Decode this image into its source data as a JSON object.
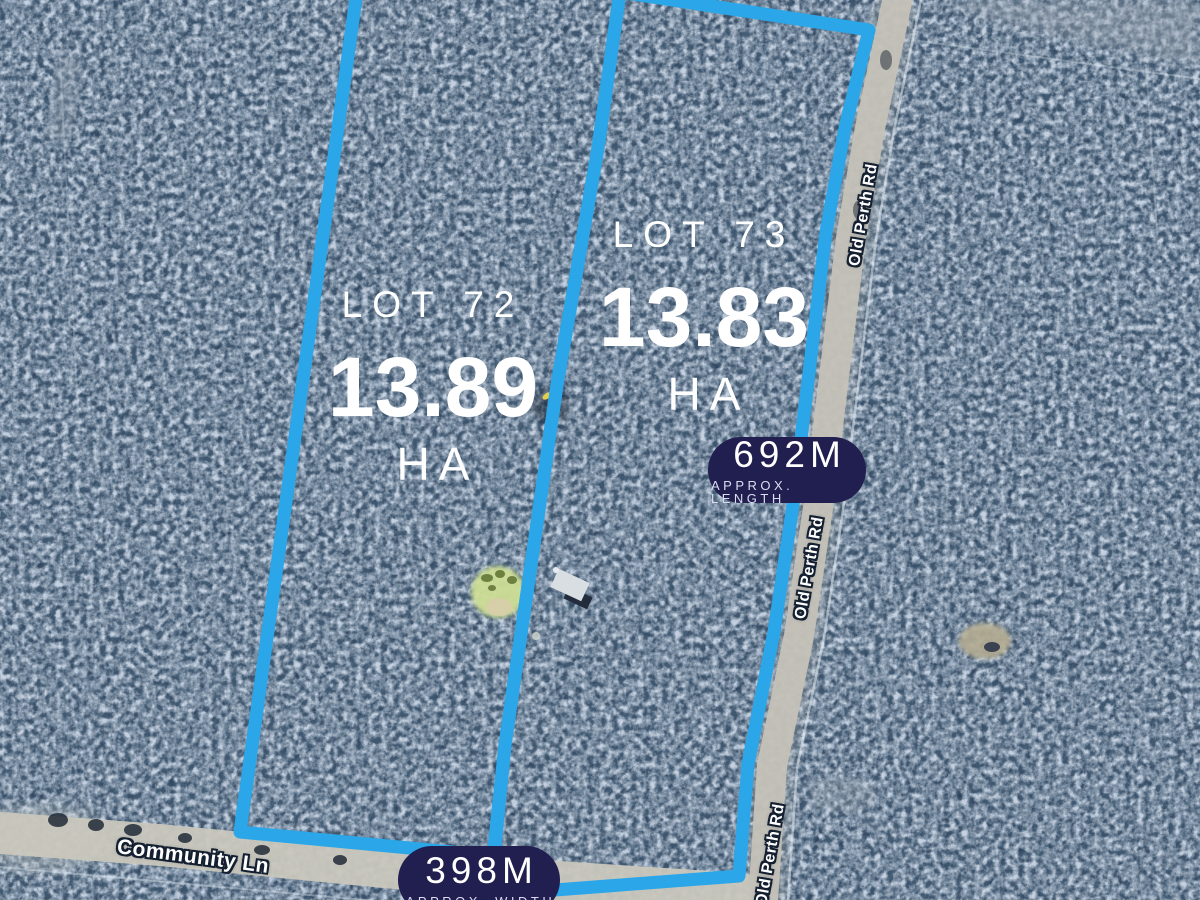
{
  "map": {
    "lots": [
      {
        "name": "LOT 72",
        "area": "13.89",
        "unit": "HA"
      },
      {
        "name": "LOT 73",
        "area": "13.83",
        "unit": "HA"
      }
    ],
    "badges": [
      {
        "value": "692M",
        "caption": "APPROX. LENGTH"
      },
      {
        "value": "398M",
        "caption": "APPROX. WIDTH"
      }
    ],
    "road_labels": [
      {
        "text": "Old Perth Rd"
      },
      {
        "text": "Old Perth Rd"
      },
      {
        "text": "Old Perth Rd"
      },
      {
        "text": "Community Ln"
      }
    ],
    "colors": {
      "boundary": "#2BA6E8",
      "badge_background": "#211F4F",
      "label_text": "#FFFFFF"
    }
  }
}
